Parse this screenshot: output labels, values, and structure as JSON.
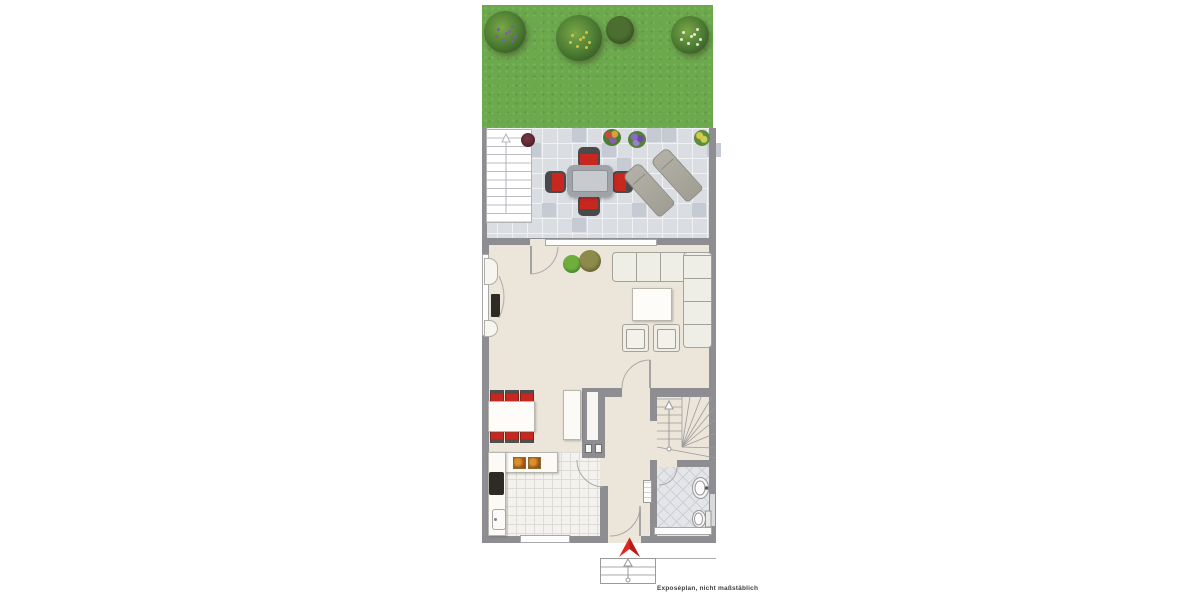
{
  "caption": {
    "text": "Exposéplan, nicht maßstäblich"
  },
  "palette": {
    "page_bg": "#ffffff",
    "grass": "#6ca94d",
    "wall": "#8d8d92",
    "floor": "#ebe5da",
    "terrace_tile": "#dadde2",
    "terrace_tile_dark": "#c6cbd3",
    "tile_grout": "#f0f1f4",
    "kitchen_tile": "#f3f2ee",
    "kitchen_grout": "#dedcd4",
    "bath_tile": "#e4e5e8",
    "bath_line": "#cdd0d7",
    "furn_white": "#fbfaf6",
    "furn_border": "#b7b5ac",
    "sofa": "#efeee6",
    "sofa_border": "#a5a399",
    "chair_red": "#c8271f",
    "chair_back": "#4a4a4a",
    "table_grey": "#c7cacf",
    "table_frame": "#9fa3a8",
    "lounger": "#a8a59b",
    "lounger_border": "#8d8a80",
    "cooktop": "#2e2a26",
    "arrow_red": "#e3251f",
    "arrow_red_dark": "#b71b15",
    "line_grey": "#9a9a9a",
    "caption_color": "#3f3f3f"
  },
  "semantics": {
    "areas": [
      "garden",
      "terrace",
      "living-room",
      "dining-area",
      "kitchen",
      "hallway",
      "bathroom",
      "winder-staircase",
      "entrance-steps"
    ],
    "objects": [
      "garden-bushes",
      "terrace-exterior-stairs",
      "potted-plants",
      "terrace-dining-set",
      "sun-loungers",
      "corner-sofa",
      "coffee-table",
      "armchairs",
      "tv-media-unit",
      "dining-table-six-chairs",
      "sideboard",
      "chimney-block",
      "kitchen-counter",
      "cooktop",
      "kitchen-sink",
      "radiator",
      "bathroom-sink",
      "toilet",
      "entrance-arrow"
    ]
  }
}
